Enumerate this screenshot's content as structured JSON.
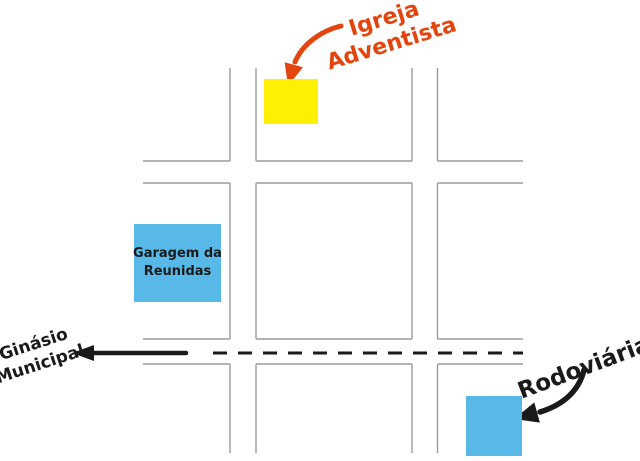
{
  "labels": {
    "igreja": {
      "line1": "Igreja",
      "line2": "Adventista"
    },
    "garagem": {
      "line1": "Garagem da",
      "line2": "Reunidas"
    },
    "ginasio": {
      "line1": "Ginásio",
      "line2": "Municipal"
    },
    "rodoviaria": {
      "text": "Rodoviária"
    }
  },
  "colors": {
    "church_marker": "#fdf000",
    "building_marker": "#58b8e8",
    "church_label": "#e2450e",
    "street_line": "#9b9b9b",
    "ink": "#1a1a1a",
    "background": "#ffffff"
  }
}
